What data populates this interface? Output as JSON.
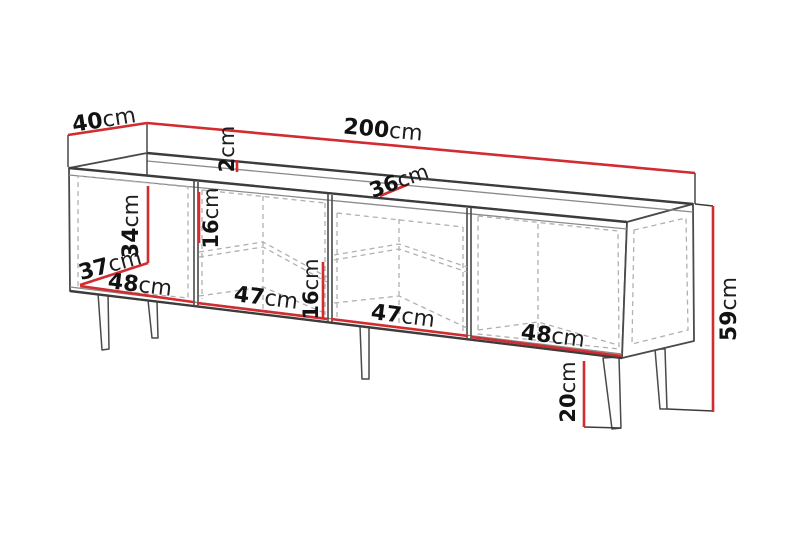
{
  "diagram": {
    "type": "furniture-dimension-diagram",
    "subject": "tv-stand-sideboard",
    "colors": {
      "dimension_line": "#d22b30",
      "outline": "#4a4a4a",
      "hidden_line": "#b0b0b0",
      "background": "#ffffff"
    },
    "dims": {
      "depth": {
        "v": "40",
        "u": "cm"
      },
      "width": {
        "v": "200",
        "u": "cm"
      },
      "top_thickness": {
        "v": "2",
        "u": "cm"
      },
      "inner_depth": {
        "v": "36",
        "u": "cm"
      },
      "door_inner_height": {
        "v": "34",
        "u": "cm"
      },
      "door_inner_depth": {
        "v": "37",
        "u": "cm"
      },
      "section1_width": {
        "v": "48",
        "u": "cm"
      },
      "upper_opening": {
        "v": "16",
        "u": "cm"
      },
      "section2_width": {
        "v": "47",
        "u": "cm"
      },
      "lower_opening": {
        "v": "16",
        "u": "cm"
      },
      "section3_width": {
        "v": "47",
        "u": "cm"
      },
      "section4_width": {
        "v": "48",
        "u": "cm"
      },
      "total_height": {
        "v": "59",
        "u": "cm"
      },
      "leg_height": {
        "v": "20",
        "u": "cm"
      }
    }
  }
}
